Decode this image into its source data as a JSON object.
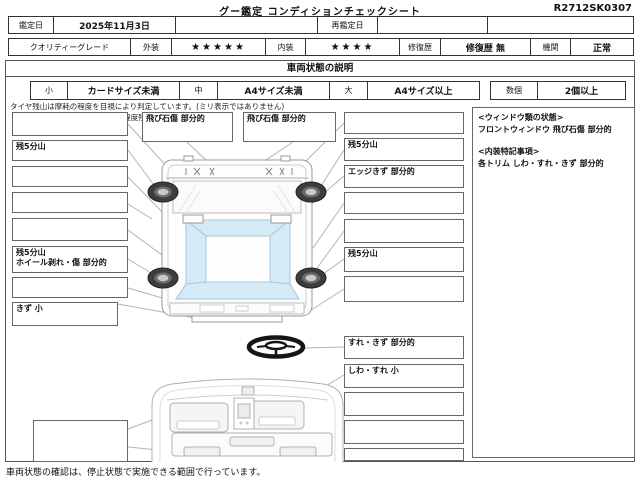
{
  "title": "グー鑑定  コンディションチェックシート",
  "code": "R2712SK0307",
  "header": {
    "date_label": "鑑定日",
    "date_value": "2025年11月3日",
    "redate_label": "再鑑定日",
    "redate_value": "",
    "quality_label": "クオリティーグレード",
    "exterior_label": "外装",
    "exterior_stars": "★★★★★",
    "interior_label": "内装",
    "interior_stars": "★★★★",
    "repair_label": "修復歴",
    "repair_value": "修復歴 無",
    "engine_label": "機関",
    "engine_value": "正常"
  },
  "section": {
    "title": "車両状態の説明",
    "size_small_label": "小",
    "size_small_value": "カードサイズ未満",
    "size_mid_label": "中",
    "size_mid_value": "A4サイズ未満",
    "size_large_label": "大",
    "size_large_value": "A4サイズ以上",
    "count_label": "数個",
    "count_value": "2個以上",
    "tire_note1": "タイヤ残山は摩耗の程度を目視により判定しています。(ミリ表示ではありません)",
    "tire_note2": "【例:残5分山=概ね50パーセント程度残り溝を示す】"
  },
  "boxes": {
    "left": [
      {
        "lines": [
          ""
        ]
      },
      {
        "lines": [
          "残5分山"
        ]
      },
      {
        "lines": [
          ""
        ]
      },
      {
        "lines": [
          ""
        ]
      },
      {
        "lines": [
          ""
        ]
      },
      {
        "lines": [
          "残5分山",
          "ホイール剥れ・傷 部分的"
        ]
      },
      {
        "lines": [
          ""
        ]
      },
      {
        "lines": [
          "きず 小"
        ]
      }
    ],
    "top": [
      {
        "lines": [
          "飛び石傷 部分的"
        ]
      },
      {
        "lines": [
          "飛び石傷 部分的"
        ]
      }
    ],
    "right": [
      {
        "lines": [
          ""
        ]
      },
      {
        "lines": [
          "残5分山"
        ]
      },
      {
        "lines": [
          "エッジきず 部分的"
        ]
      },
      {
        "lines": [
          ""
        ]
      },
      {
        "lines": [
          ""
        ]
      },
      {
        "lines": [
          "残5分山"
        ]
      },
      {
        "lines": [
          ""
        ]
      },
      {
        "lines": [
          "すれ・きず 部分的"
        ]
      },
      {
        "lines": [
          "しわ・すれ 小"
        ]
      },
      {
        "lines": [
          ""
        ]
      },
      {
        "lines": [
          ""
        ]
      },
      {
        "lines": [
          ""
        ]
      }
    ],
    "bottom_left": {
      "lines": [
        ""
      ]
    }
  },
  "notes_panel": {
    "window_header": "<ウィンドウ類の状態>",
    "window_detail": "フロントウィンドウ 飛び石傷 部分的",
    "interior_header": "<内装特記事項>",
    "interior_detail": "各トリム しわ・すれ・きず 部分的"
  },
  "footer": "車両状態の確認は、停止状態で実施できる範囲で行っています。",
  "colors": {
    "glass_blue": "#d4eaf6",
    "line_art": "#9a9a9a",
    "leader_line": "#b4b4b4",
    "table_border": "#333333",
    "wheel_dark": "#3d3d3d"
  }
}
